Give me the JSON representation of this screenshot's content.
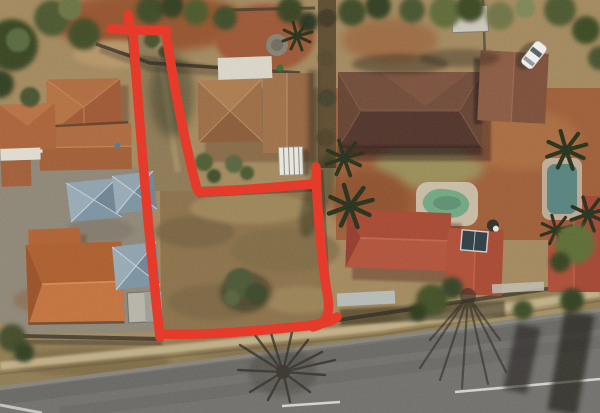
{
  "scene": {
    "type": "aerial-satellite-photograph",
    "description": "Overhead satellite view of a suburban block: terracotta-roofed houses, dense trees, a paved courtyard with three blue-grey shade canopies, two swimming pools, a white car on a driveway, a diagonal street with a grass verge and footpath along the bottom, and a vacant panhandle plot of dry brown grass outlined with a thick hand-drawn red boundary.",
    "visible_text": "none"
  },
  "annotation": {
    "meaning": "hand-drawn red outline marking a vacant flag/panhandle lot with narrow access strip to the top boundary",
    "color": "#e63b2b",
    "stroke_width": 9.5,
    "strokes": [
      {
        "name": "overshoot-nub",
        "path": "M128,15 L130,28"
      },
      {
        "name": "top-bar",
        "path": "M111,29 L167,31"
      },
      {
        "name": "west-boundary",
        "path": "M133,31 C139,120 149,240 160,337"
      },
      {
        "name": "access-strip-east-edge",
        "path": "M166,32 C174,90 189,160 197,189"
      },
      {
        "name": "north-boundary",
        "path": "M199,192 C235,191 275,187 313,184"
      },
      {
        "name": "east-boundary",
        "path": "M316,167 C317,215 323,270 328,298 C330,314 327,323 313,327"
      },
      {
        "name": "south-boundary",
        "path": "M160,334 C205,336 265,330 305,326 C320,324 332,322 337,317"
      }
    ]
  },
  "features": {
    "vacant_plot": {
      "ground": "dry brown grass with green bush cluster near centre",
      "access": "narrow strip running north to the street block edge"
    },
    "houses": [
      {
        "id": "top-left-house",
        "roof_color": "#a85e34"
      },
      {
        "id": "left-edge-house",
        "roof_color": "#ab6136"
      },
      {
        "id": "bottom-left-house",
        "roof_color": "#ad5c2a"
      },
      {
        "id": "north-house",
        "roof_color": "#9c6b42",
        "extras": "white patio roof, white caravan, garden bushes"
      },
      {
        "id": "top-right-house",
        "roof_color": "#64402f",
        "extras": "garage wing, white car in driveway"
      },
      {
        "id": "red-roof-house",
        "roof_color": "#a8462f",
        "extras": "solar panel, satellite dish, kidney pool"
      },
      {
        "id": "far-right-red-roof-house",
        "roof_color": "#a4432f",
        "extras": "teal pool under palm trees"
      }
    ],
    "canopies": {
      "count": 3,
      "color": "#7b93a2",
      "location": "paved courtyard, left-centre"
    },
    "pools": [
      {
        "id": "kidney-pool",
        "water_color": "#6fa881"
      },
      {
        "id": "right-pool",
        "water_color": "#55827e"
      }
    ],
    "road": {
      "position": "diagonal along bottom edge",
      "surface": "#706f6b",
      "markings": "white dashed lane line and edge line",
      "verge": "dry grass with pale footpath and bare winter tree shadows"
    },
    "car": {
      "color": "white",
      "location": "top-right driveway"
    }
  },
  "palette": {
    "ground_tan": "#a3885c",
    "bare_dirt": "#955129",
    "plot_grass": "#8b7048",
    "courtyard_paving": "#8e8675",
    "verge": "#8f7b50",
    "road": "#706f6b",
    "footpath": "#c7b68d",
    "tree_dark": "#35431f",
    "wall": "#3e372b"
  }
}
